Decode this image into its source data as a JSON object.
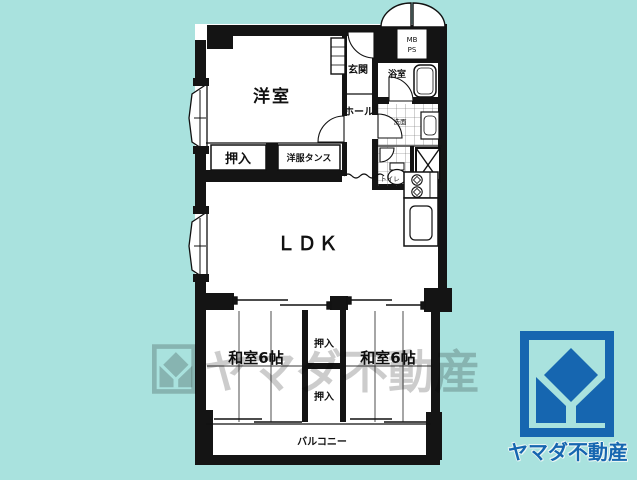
{
  "canvas": {
    "bg_color": "#a9e2de",
    "line_color": "#111111"
  },
  "floorplan": {
    "labels": {
      "western_room": "洋室",
      "entrance": "玄関",
      "mb": "MB",
      "ps": "PS",
      "bathroom": "浴室",
      "hall": "ホール",
      "washroom": "洗面",
      "toilet": "トイレ",
      "closet_upper_row": "押入",
      "wardrobe": "洋服タンス",
      "ldk": "ＬＤＫ",
      "japanese_room_left": "和室6帖",
      "japanese_room_right": "和室6帖",
      "closet_mid_upper": "押入",
      "closet_mid_lower": "押入",
      "balcony": "バルコニー"
    }
  },
  "watermark": {
    "text": "ヤマダ不動産",
    "color": "rgba(0,0,0,0.20)"
  },
  "logo": {
    "company": "ヤマダ不動産",
    "brand_color": "#1666b0"
  }
}
